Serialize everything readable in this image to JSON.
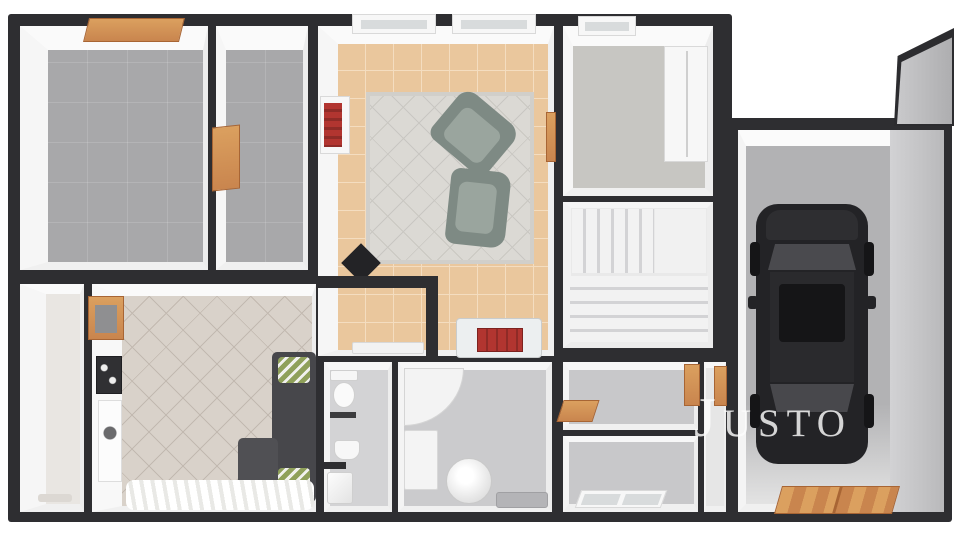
{
  "watermark": {
    "text": "Justo"
  },
  "scene": {
    "type": "3d-floor-plan-render",
    "rooms": [
      {
        "id": "bedroom-top-left",
        "floor": "gray-carpet"
      },
      {
        "id": "bedroom-top-middle",
        "floor": "gray-carpet"
      },
      {
        "id": "living-room",
        "floor": "tan-tile",
        "furniture": [
          "rug",
          "armchair",
          "armchair",
          "bookshelf",
          "black-side-table"
        ]
      },
      {
        "id": "bedroom-top-right",
        "floor": "gray",
        "furniture": [
          "wardrobe"
        ]
      },
      {
        "id": "staircase",
        "floor": "white-stairs"
      },
      {
        "id": "hallway",
        "floor": "tan-tile",
        "furniture": [
          "red-bench"
        ]
      },
      {
        "id": "pantry",
        "floor": "tan-tile",
        "furniture": [
          "bench"
        ]
      },
      {
        "id": "storage-closet-left",
        "floor": "light-tile"
      },
      {
        "id": "kitchen-room-bottom-left",
        "floor": "diagonal-tile",
        "furniture": [
          "sofa",
          "chaise",
          "white-rug",
          "wall-art",
          "serving-hatch"
        ]
      },
      {
        "id": "wc",
        "floor": "gray",
        "furniture": [
          "toilet",
          "sink",
          "washer"
        ]
      },
      {
        "id": "bathroom",
        "floor": "gray",
        "furniture": [
          "corner-tub",
          "counter",
          "round-washer",
          "bath-mat"
        ]
      },
      {
        "id": "room-bottom-center",
        "floor": "gray"
      },
      {
        "id": "room-bottom-center-lower",
        "floor": "gray",
        "features": [
          "double-window"
        ]
      },
      {
        "id": "rear-hallway",
        "floor": "light"
      },
      {
        "id": "garage",
        "floor": "concrete-gray",
        "furniture": [
          "car"
        ],
        "features": [
          "wood-double-door"
        ]
      }
    ]
  },
  "colors": {
    "wall": "#2e2e31",
    "wall_face": "#f6f6f6",
    "carpet": "#a8a8aa",
    "tile_tan": "#eac79d",
    "tile_tan_grout": "#f4ddc0",
    "tile_diag": "#d9d2ca",
    "tile_diag_line": "#c2b9b0",
    "rug": "#dbd9d4",
    "rug_line": "#c9c7c2",
    "floor_gray": "#c8c8ca",
    "floor_light": "#e9e6e2",
    "stair_light": "#f2f2f2",
    "stair_dark": "#d3d3d5",
    "wood": "#c9854e",
    "wood_light": "#dba05f",
    "wood_dark": "#a86534",
    "accent_red": "#b23530",
    "accent_red_dark": "#8f2b27",
    "sofa": "#47474b",
    "pillow_green": "#8fa05a",
    "chair_body": "#7e8a84",
    "chair_cushion": "#9aa59e",
    "car_body": "#232326",
    "car_roof": "#2a2a2d",
    "car_glass": "#4a4a4e",
    "glass": "#d8dbdc",
    "garage_floor": "#b2b2b4",
    "garage_wall_face": "#c7c7c9",
    "watermark_color": "rgba(252,252,252,0.82)"
  }
}
